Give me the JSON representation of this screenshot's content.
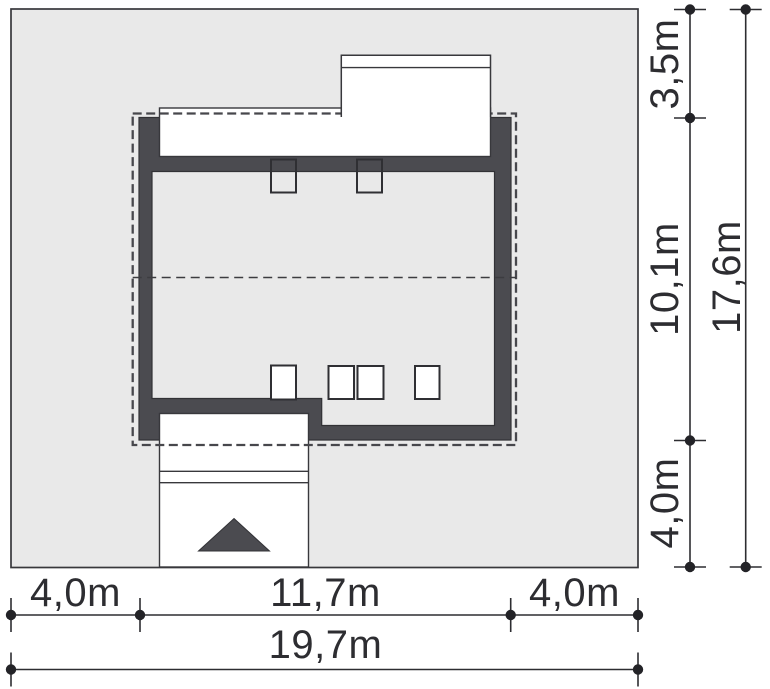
{
  "plan": {
    "description_labels": {},
    "colors": {
      "plot_fill": "#e9e9e9",
      "wall_fill": "#4b4b50",
      "outline": "#38383c",
      "dash": "#47474c",
      "text": "#2d2d31",
      "white": "#ffffff"
    }
  },
  "dimensions": {
    "right": {
      "seg_top": "3,5m",
      "seg_mid": "10,1m",
      "seg_bottom": "4,0m",
      "total": "17,6m"
    },
    "bottom": {
      "seg_left": "4,0m",
      "seg_mid": "11,7m",
      "seg_right": "4,0m",
      "total": "19,7m"
    }
  }
}
